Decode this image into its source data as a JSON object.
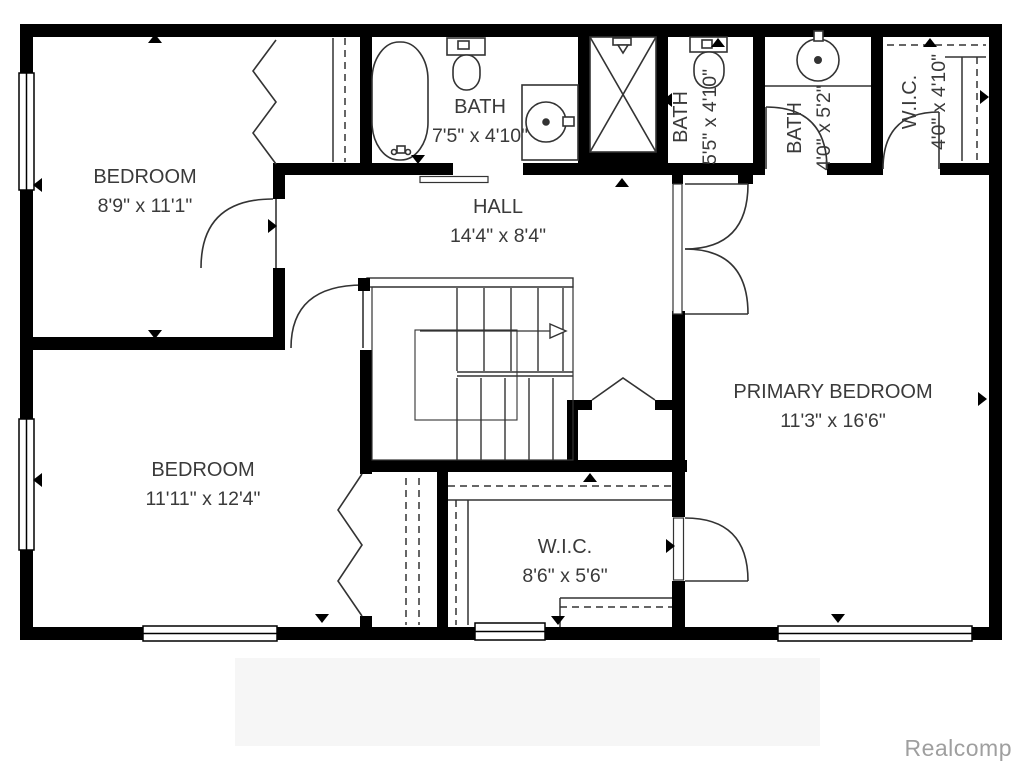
{
  "rooms": [
    {
      "id": "bedroom-1",
      "name": "BEDROOM",
      "dims": "8'9\" x 11'1\"",
      "orientation": "horizontal"
    },
    {
      "id": "bath-1",
      "name": "BATH",
      "dims": "7'5\" x 4'10\"",
      "orientation": "horizontal"
    },
    {
      "id": "hall",
      "name": "HALL",
      "dims": "14'4\" x 8'4\"",
      "orientation": "horizontal"
    },
    {
      "id": "bath-2",
      "name": "BATH",
      "dims": "5'5\" x 4'10\"",
      "orientation": "vertical"
    },
    {
      "id": "bath-3",
      "name": "BATH",
      "dims": "4'0\" x 5'2\"",
      "orientation": "vertical"
    },
    {
      "id": "wic-2",
      "name": "W.I.C.",
      "dims": "4'0\" x 4'10\"",
      "orientation": "vertical"
    },
    {
      "id": "primary-bedroom",
      "name": "PRIMARY BEDROOM",
      "dims": "11'3\" x 16'6\"",
      "orientation": "horizontal"
    },
    {
      "id": "bedroom-2",
      "name": "BEDROOM",
      "dims": "11'11\" x 12'4\"",
      "orientation": "horizontal"
    },
    {
      "id": "wic-1",
      "name": "W.I.C.",
      "dims": "8'6\" x 5'6\"",
      "orientation": "horizontal"
    }
  ],
  "fixtures": [
    "bathtub",
    "toilet",
    "toilet",
    "sink",
    "sink",
    "shower",
    "staircase",
    "closet-rods"
  ],
  "watermark": {
    "text": "Realcomp"
  },
  "colors": {
    "wall": "#000000",
    "line": "#333333",
    "label_text": "#3a3a3a",
    "watermark_text": "#9f9f9f",
    "background": "#ffffff"
  }
}
